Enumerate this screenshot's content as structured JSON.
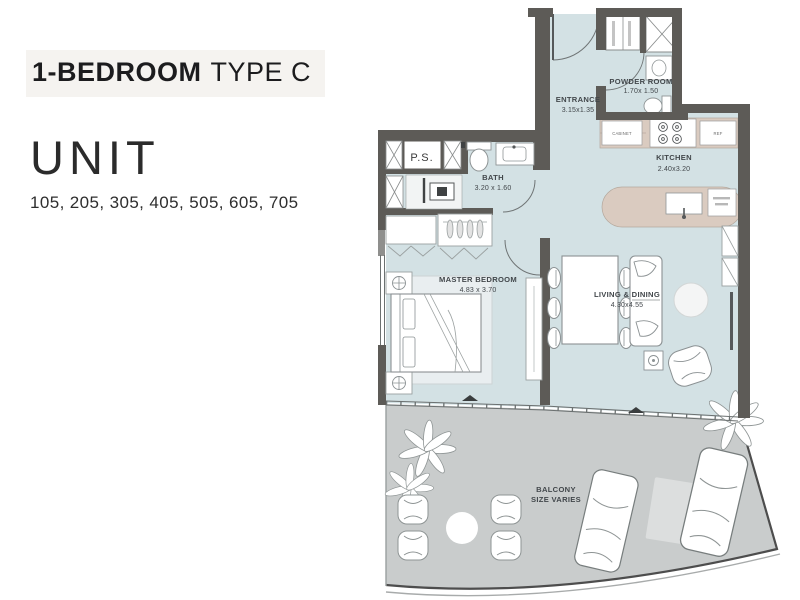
{
  "panel": {
    "title_main": "1-BEDROOM",
    "title_sub": "TYPE C",
    "unit_heading": "UNIT",
    "unit_numbers": "105, 205, 305, 405, 505, 605, 705"
  },
  "floorplan": {
    "entrance": {
      "name": "ENTRANCE",
      "dims": "3.15x1.35"
    },
    "powder_room": {
      "name": "POWDER ROOM",
      "dims": "1.70x 1.50"
    },
    "kitchen": {
      "name": "KITCHEN",
      "dims": "2.40x3.20"
    },
    "bath": {
      "name": "BATH",
      "dims": "3.20 x 1.60"
    },
    "master_bedroom": {
      "name": "MASTER BEDROOM",
      "dims": "4.83 x 3.70"
    },
    "living_dining": {
      "name": "LIVING & DINING",
      "dims": "4.30x4.55"
    },
    "balcony": {
      "name": "BALCONY",
      "dims": "SIZE VARIES"
    },
    "ps_label": "P.S.",
    "appliances": {
      "cabinet": "CABINET",
      "ref": "REF"
    },
    "colors": {
      "floor": "#d3e1e4",
      "balcony": "#c9cccc",
      "wall": "#5d5b57",
      "counter": "#dacbc0",
      "title_background": "#f5f3f0"
    }
  }
}
